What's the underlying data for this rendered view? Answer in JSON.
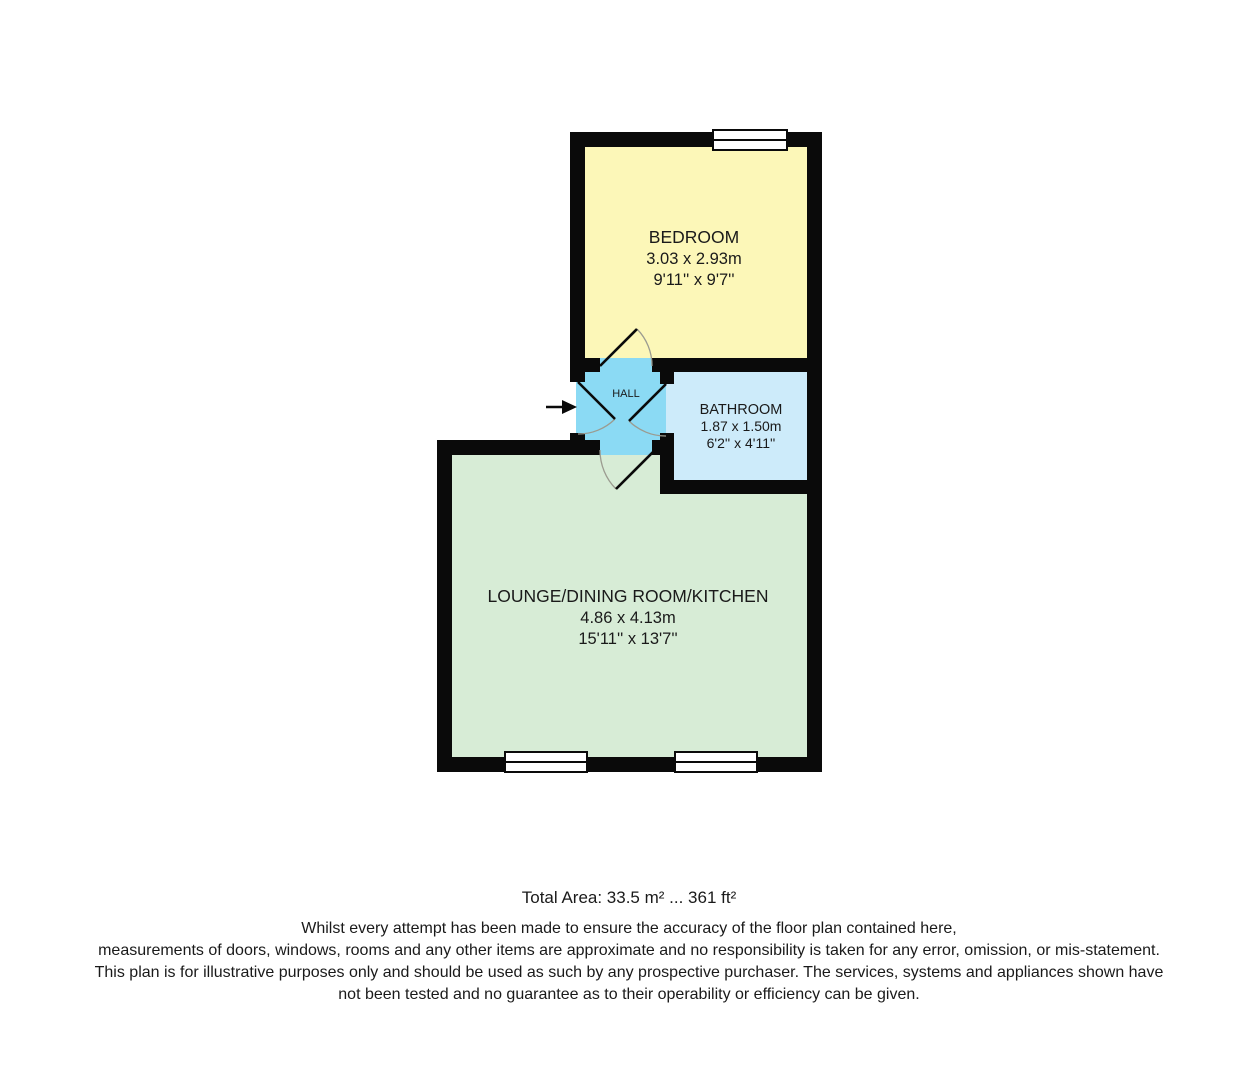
{
  "floorplan": {
    "rooms": {
      "bedroom": {
        "name": "BEDROOM",
        "size_metric": "3.03 x 2.93m",
        "size_imperial": "9'11'' x 9'7''",
        "color": "#FCF7B8"
      },
      "hall": {
        "name": "HALL",
        "color": "#8BDAF4"
      },
      "bathroom": {
        "name": "BATHROOM",
        "size_metric": "1.87 x 1.50m",
        "size_imperial": "6'2'' x 4'11''",
        "color": "#CDEBFA"
      },
      "lounge": {
        "name": "LOUNGE/DINING ROOM/KITCHEN",
        "size_metric": "4.86 x 4.13m",
        "size_imperial": "15'11'' x 13'7''",
        "color": "#D7ECD6"
      }
    },
    "wall_color": "#0a0a0a"
  },
  "footer": {
    "total_area": "Total Area: 33.5 m² ... 361 ft²",
    "disclaimer_lines": [
      "Whilst every attempt has been made to ensure the accuracy of the floor plan contained here,",
      "measurements of doors, windows, rooms and any other items are approximate and no responsibility is taken for any error, omission, or mis-statement.",
      "This plan is for illustrative purposes only and should be used as such by any prospective purchaser. The services, systems and appliances shown have",
      "not been tested and no guarantee as to their operability or efficiency can be given."
    ]
  }
}
